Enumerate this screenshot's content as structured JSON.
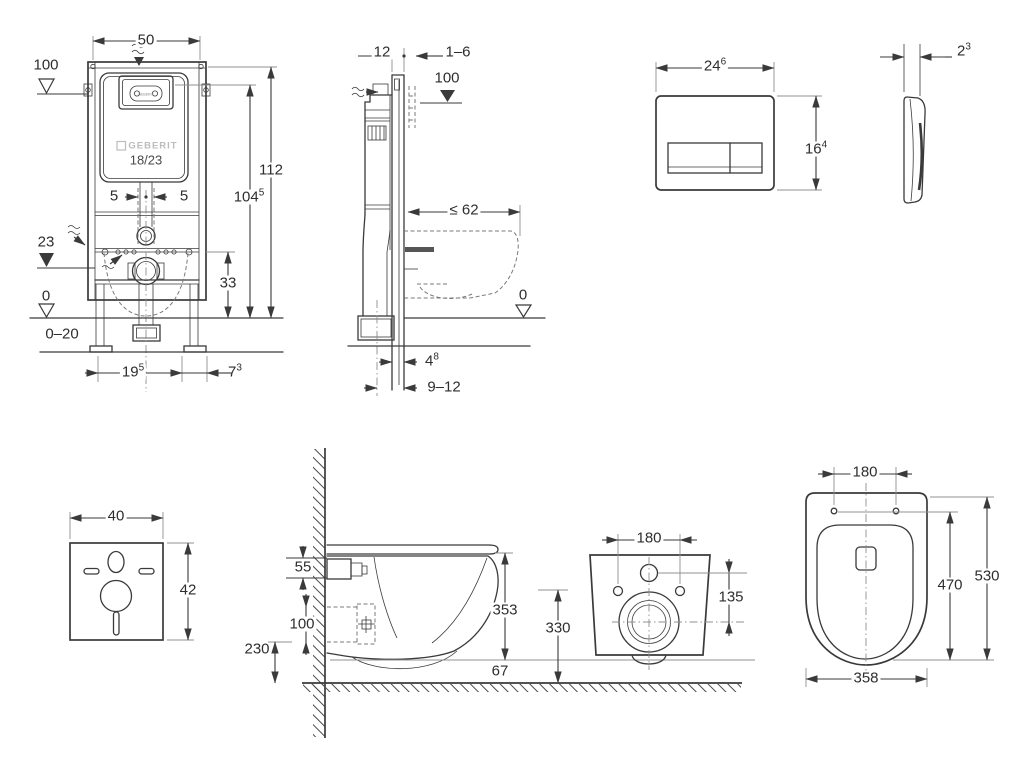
{
  "colors": {
    "line": "#3a3a3a",
    "light": "#909090",
    "dash": "#7a7a7a",
    "text": "#2e2e2e",
    "watermark": "#bcbcbc",
    "bg": "#ffffff",
    "accentfill": "#555555"
  },
  "views": {
    "frame_front": {
      "title": "installation-frame-front-view",
      "brand_watermark": "GEBERIT",
      "logo_small": "GEBERIT",
      "model": "18/23",
      "dims": {
        "width": {
          "text": "50"
        },
        "supply_level": {
          "text": "100"
        },
        "total_height": {
          "text": "112"
        },
        "plate_center": {
          "text": "104",
          "sup": "5"
        },
        "fix_left": {
          "text": "5"
        },
        "fix_right": {
          "text": "5"
        },
        "outlet_level": {
          "text": "23"
        },
        "outlet_height": {
          "text": "33"
        },
        "zero_level": {
          "text": "0"
        },
        "adjust_range": {
          "text": "0–20"
        },
        "foot_offset": {
          "text": "19",
          "sup": "5"
        },
        "foot_width": {
          "text": "7",
          "sup": "3"
        }
      }
    },
    "frame_side": {
      "title": "installation-frame-side-view",
      "dims": {
        "depth": {
          "text": "12"
        },
        "finish_thickness": {
          "text": "1–6"
        },
        "supply_level": {
          "text": "100"
        },
        "max_depth": {
          "text": "≤ 62"
        },
        "zero_level": {
          "text": "0"
        },
        "pipe_offset": {
          "text": "4",
          "sup": "8"
        },
        "outlet_range": {
          "text": "9–12"
        }
      }
    },
    "flush_plate": {
      "title": "flush-plate-views",
      "dims": {
        "width": {
          "text": "24",
          "sup": "6"
        },
        "height": {
          "text": "16",
          "sup": "4"
        },
        "thickness": {
          "text": "2",
          "sup": "3"
        }
      }
    },
    "sound_mat": {
      "title": "sound-insulation-mat",
      "dims": {
        "width": {
          "text": "40"
        },
        "height": {
          "text": "42"
        }
      }
    },
    "wc_side": {
      "title": "wc-pan-side-view",
      "dims": {
        "bracket_height": {
          "text": "55"
        },
        "inlet_zone": {
          "text": "100"
        },
        "outlet_to_floor": {
          "text": "230"
        },
        "body_height": {
          "text": "353"
        },
        "floor_clearance": {
          "text": "67"
        }
      }
    },
    "wc_front": {
      "title": "wc-pan-rear-view",
      "dims": {
        "hole_spacing": {
          "text": "180"
        },
        "hole_to_outlet": {
          "text": "135"
        },
        "height_above_floor": {
          "text": "330"
        }
      }
    },
    "wc_top": {
      "title": "wc-pan-top-view",
      "dims": {
        "hole_spacing": {
          "text": "180"
        },
        "hole_to_front": {
          "text": "470"
        },
        "total_depth": {
          "text": "530"
        },
        "width": {
          "text": "358"
        }
      }
    }
  }
}
